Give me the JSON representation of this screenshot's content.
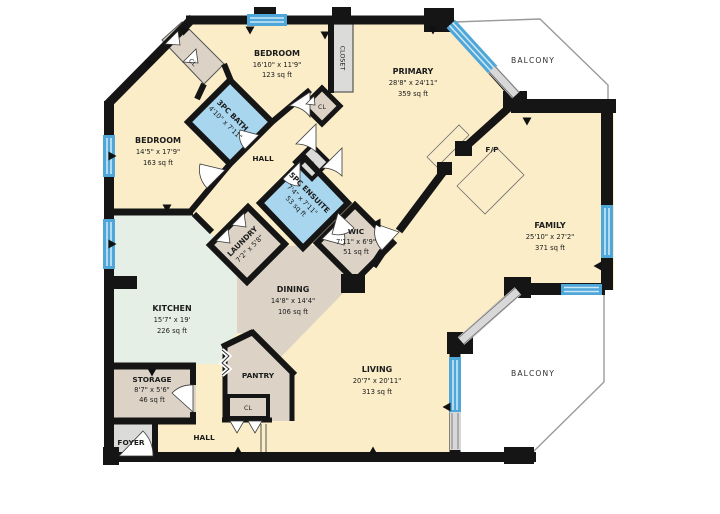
{
  "rooms": {
    "bedroom_top": {
      "name": "BEDROOM",
      "dims": "16'10\" x 11'9\"",
      "area": "123 sq ft"
    },
    "bedroom_left": {
      "name": "BEDROOM",
      "dims": "14'5\" x 17'9\"",
      "area": "163 sq ft"
    },
    "primary": {
      "name": "PRIMARY",
      "dims": "28'8\" x 24'11\"",
      "area": "359 sq ft"
    },
    "family": {
      "name": "FAMILY",
      "dims": "25'10\" x 27'2\"",
      "area": "371 sq ft"
    },
    "living": {
      "name": "LIVING",
      "dims": "20'7\" x 20'11\"",
      "area": "313 sq ft"
    },
    "dining": {
      "name": "DINING",
      "dims": "14'8\" x 14'4\"",
      "area": "106 sq ft"
    },
    "kitchen": {
      "name": "KITCHEN",
      "dims": "15'7\" x 19'",
      "area": "226 sq ft"
    },
    "storage": {
      "name": "STORAGE",
      "dims": "8'7\" x 5'6\"",
      "area": "46 sq ft"
    },
    "bath_3pc": {
      "name": "3PC BATH",
      "dims": "4'10\" x 7'11\""
    },
    "ensuite_5pc": {
      "name": "5PC ENSUITE",
      "dims": "7'4\" x 7'11\"",
      "area": "53 sq ft"
    },
    "wic": {
      "name": "WIC",
      "dims": "7'11\" x 6'9\"",
      "area": "51 sq ft"
    },
    "laundry": {
      "name": "LAUNDRY",
      "dims": "7'2\" x 5'8\""
    },
    "pantry": {
      "name": "PANTRY"
    },
    "foyer": {
      "name": "FOYER"
    },
    "hall_upper": {
      "name": "HALL"
    },
    "hall_lower": {
      "name": "HALL"
    },
    "closet": {
      "name": "CLOSET"
    },
    "closet_cl_top": {
      "name": "CL"
    },
    "closet_cl_mid": {
      "name": "CL"
    },
    "closet_cl_pantry": {
      "name": "CL"
    },
    "closet_c": {
      "name": "C"
    },
    "fireplace": {
      "name": "F/P"
    },
    "balcony_ne": {
      "name": "BALCONY"
    },
    "balcony_se": {
      "name": "BALCONY"
    }
  },
  "colors": {
    "room_cream": "#FAEDC8",
    "room_taupe": "#DCD3C6",
    "room_mint": "#E6EFE5",
    "room_blue": "#A9D6EF",
    "room_gray": "#DBDBD9",
    "wall": "#151515",
    "window_blue": "#4FA6D8",
    "slider_gray": "#D8D8D8",
    "balcony_outline": "#9A9A9A"
  }
}
